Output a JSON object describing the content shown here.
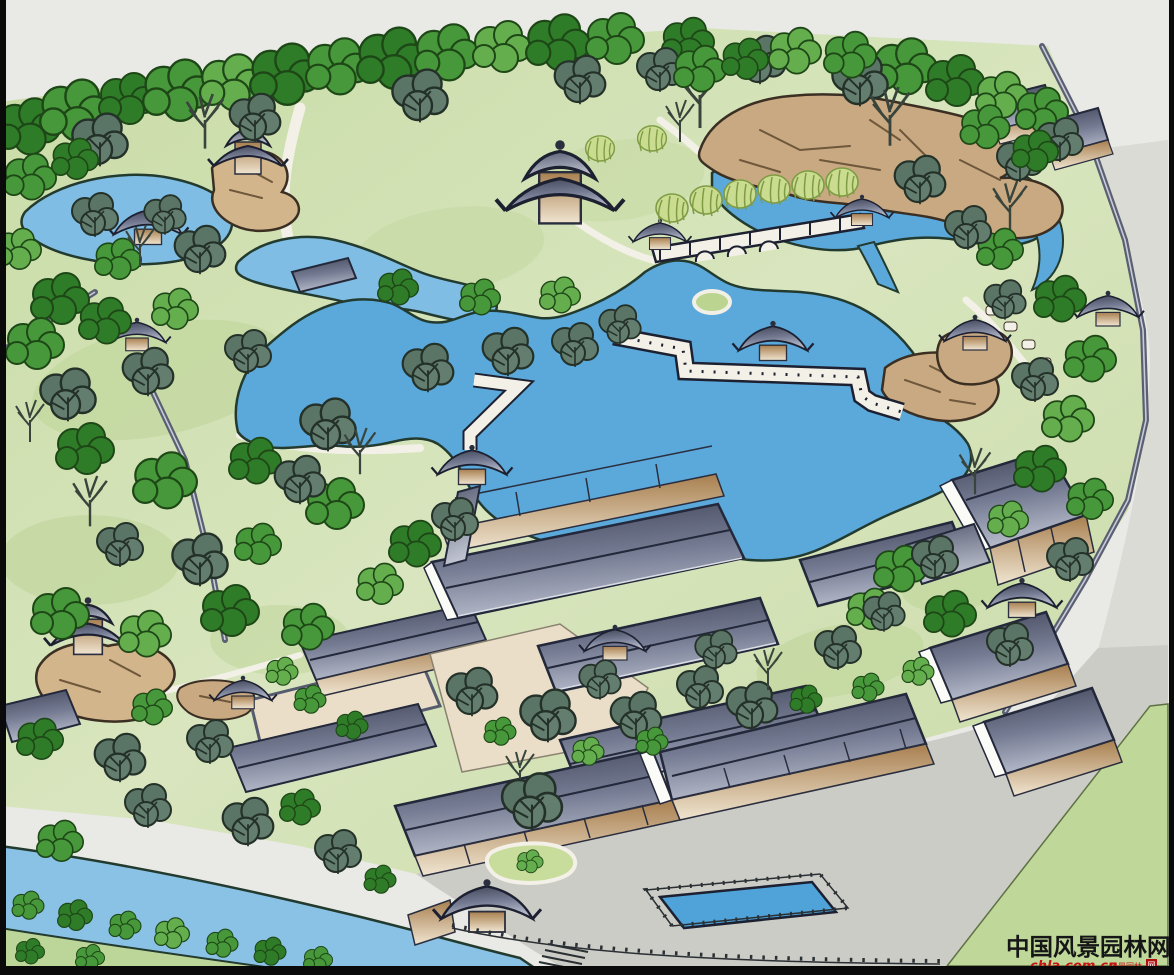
{
  "document": {
    "type": "hand-drawn landscape master plan rendering",
    "subject": "Classical Chinese garden site plan: central lake with zig-zag bridges and pavilions, north rockery pond with willow corridor bridge, courtyard building complex, entry plaza with rectangular pool, canal along the south-west edge"
  },
  "watermark": {
    "site_name": "中国风景园林网",
    "url": "chla.com.cn",
    "tagline": "风景园林",
    "seal": "网"
  },
  "palette": {
    "background": "#E9E9E5",
    "lawn": "#CFE0AE",
    "lawn_light": "#DFE9CB",
    "lake_blue": "#5BA8DB",
    "pond_blue": "#7FBDE4",
    "river_blue": "#8AC2E6",
    "pool_blue": "#4FA3D8",
    "rock_tan": "#C9A981",
    "roof_dark": "#3E4356",
    "roof_light": "#B6BBCB",
    "wall_tan": "#A87F4F",
    "plaza_gray": "#CBCCC6",
    "court_beige": "#EADEC8",
    "willow_green": "#C9DC90",
    "tree_green": "#47983A",
    "watermark_red": "#C41212",
    "watermark_black": "#161616",
    "border_black": "#0A0A0A"
  },
  "features": [
    {
      "label": "north tree belt"
    },
    {
      "label": "north-west pond with mound pavilion"
    },
    {
      "label": "north-east rockery and pond"
    },
    {
      "label": "willow corridor bridge"
    },
    {
      "label": "two-storey pagoda"
    },
    {
      "label": "central lake"
    },
    {
      "label": "zig-zag bridge with mid-lake pavilion"
    },
    {
      "label": "waterside pavilion"
    },
    {
      "label": "courtyard building complex"
    },
    {
      "label": "two-storey waterside hall"
    },
    {
      "label": "hexagonal pavilion on rockery"
    },
    {
      "label": "entry gate and plaza"
    },
    {
      "label": "rectangular pool"
    },
    {
      "label": "south-west canal"
    }
  ]
}
